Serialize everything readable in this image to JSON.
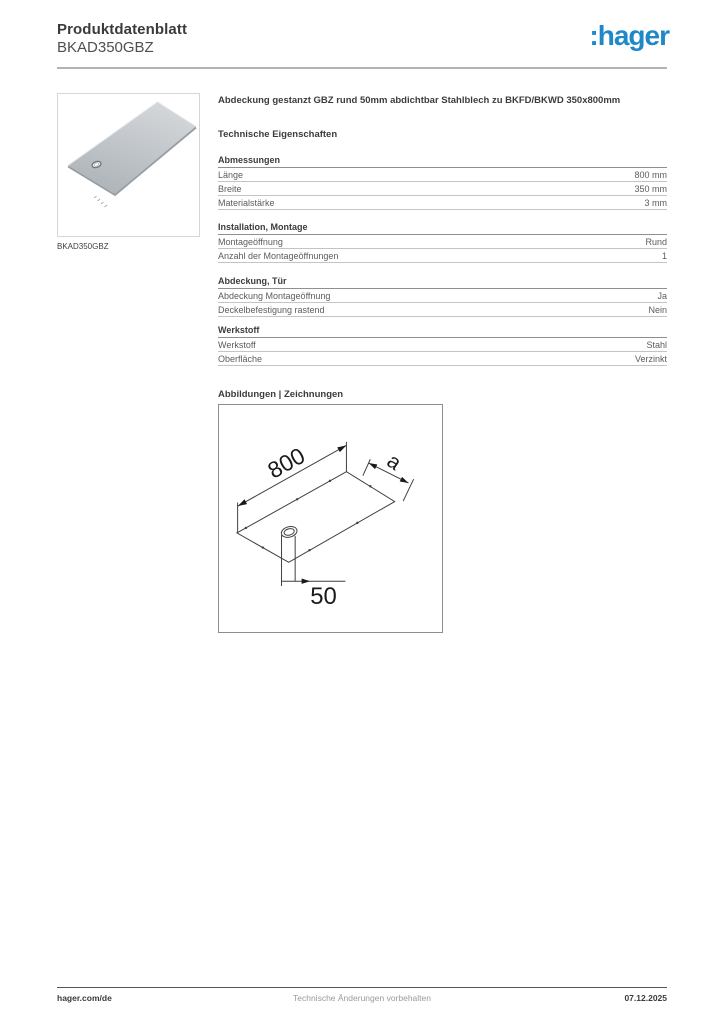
{
  "header": {
    "doc_type": "Produktdatenblatt",
    "product_ref": "BKAD350GBZ",
    "logo_text": ":hager",
    "logo_color": "#1f88c8"
  },
  "product": {
    "image_caption": "BKAD350GBZ",
    "title": "Abdeckung gestanzt GBZ rund 50mm abdichtbar Stahlblech zu BKFD/BKWD 350x800mm"
  },
  "tech_heading": "Technische Eigenschaften",
  "sections": [
    {
      "title": "Abmessungen",
      "rows": [
        {
          "label": "Länge",
          "value": "800 mm"
        },
        {
          "label": "Breite",
          "value": "350 mm"
        },
        {
          "label": "Materialstärke",
          "value": "3 mm"
        }
      ]
    },
    {
      "title": "Installation, Montage",
      "rows": [
        {
          "label": "Montageöffnung",
          "value": "Rund"
        },
        {
          "label": "Anzahl der Montageöffnungen",
          "value": "1"
        }
      ]
    },
    {
      "title": "Abdeckung, Tür",
      "rows": [
        {
          "label": "Abdeckung Montageöffnung",
          "value": "Ja"
        },
        {
          "label": "Deckelbefestigung rastend",
          "value": "Nein"
        }
      ]
    },
    {
      "title": "Werkstoff",
      "rows": [
        {
          "label": "Werkstoff",
          "value": "Stahl"
        },
        {
          "label": "Oberfläche",
          "value": "Verzinkt"
        }
      ]
    }
  ],
  "drawings_heading": "Abbildungen | Zeichnungen",
  "drawing": {
    "length_label": "800",
    "width_label": "a",
    "hole_offset_label": "50"
  },
  "footer": {
    "left": "hager.com/de",
    "center": "Technische Änderungen vorbehalten",
    "right": "07.12.2025"
  }
}
